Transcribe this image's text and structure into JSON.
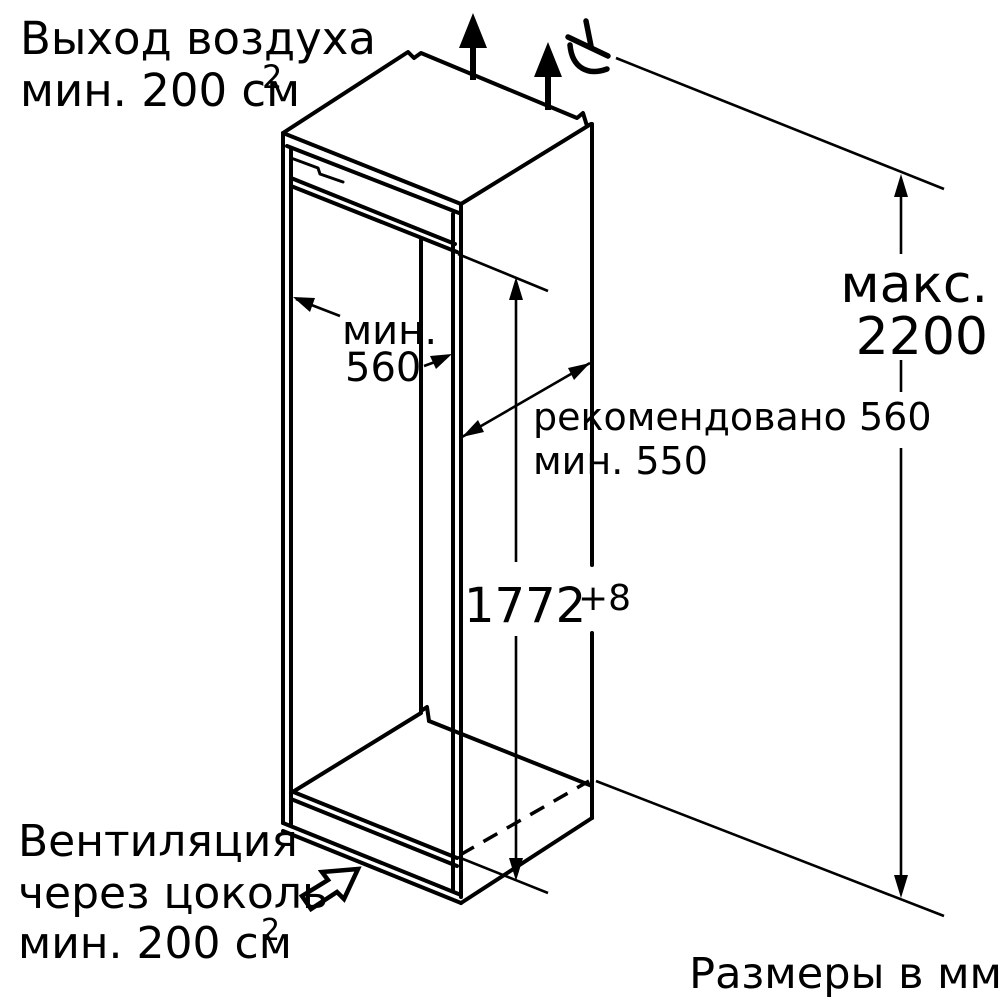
{
  "diagram": {
    "kind": "built-in appliance niche installation drawing",
    "units_note": "Размеры в мм",
    "colors": {
      "line": "#000000",
      "background": "#ffffff"
    },
    "annotations": {
      "air_outlet": {
        "line1": "Выход воздуха",
        "line2": "мин. 200 см",
        "sup": "2"
      },
      "niche_width": {
        "line1": "мин.",
        "line2": "560"
      },
      "niche_depth": {
        "line1": "рекомендовано 560",
        "line2": "мин. 550"
      },
      "niche_height": {
        "value": "1772",
        "tolerance": "+8"
      },
      "max_height": {
        "line1": "макс.",
        "line2": "2200"
      },
      "plinth_vent": {
        "line1": "Вентиляция",
        "line2": "через цоколь",
        "line3": "мин. 200 см",
        "sup": "2"
      }
    },
    "icons": {
      "top_vent": "upward-airflow-arrow-icon",
      "socket": "power-socket-icon",
      "plinth_vent": "hollow-airflow-arrow-icon"
    }
  }
}
